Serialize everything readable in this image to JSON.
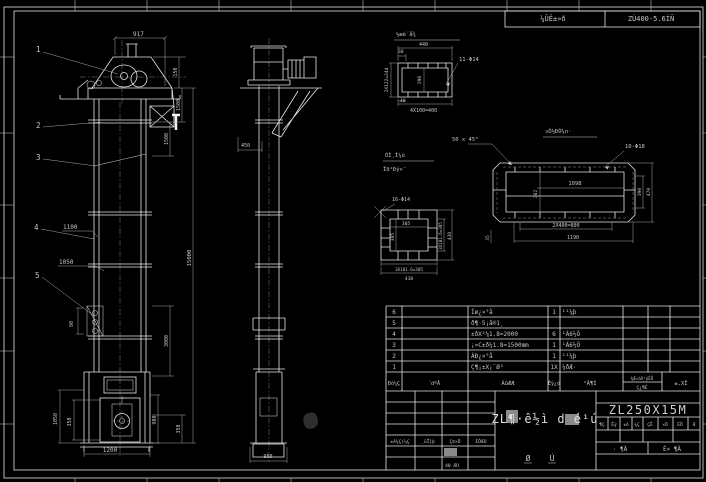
{
  "top_header": {
    "cell_left": "¼ÛÊ±»ð",
    "cell_right": "ZÙ400-5.6ÍÑ"
  },
  "front_view": {
    "balloons": [
      "1",
      "2",
      "3",
      "4",
      "5"
    ],
    "dim_top": "917",
    "dim_150": "150",
    "dim_1500a": "1500",
    "dim_1500b": "1500",
    "dim_3000": "3000",
    "dim_total": "15000",
    "callout_1100": "1100",
    "callout_1050": "1050",
    "dim_bucket": "90",
    "boot_left": "1050",
    "boot_left_inner": "350",
    "boot_right": "900",
    "dim_350": "350",
    "dim_base": "1200"
  },
  "side_view": {
    "dim_chute": "450",
    "dim_base": "950"
  },
  "detail_flange": {
    "title": "½æê´å¾",
    "dim_width": "440",
    "dim_30": "30",
    "dim_left": "2X122=244",
    "dim_inner": "296",
    "holes": "11-Φ14",
    "dim_40": "40",
    "dim_bottom": "4X100=400"
  },
  "chamfer_note": "50 x 45°",
  "weld_note": {
    "line1": "ÓÌ¸Ì¼ú",
    "line2": "Ïð²Ðý×¨"
  },
  "detail_square": {
    "holes": "16-Φ14",
    "dim_inner_w": "305",
    "dim_inner_h": "305",
    "dim_right": "3X101.6=305",
    "dim_right_total": "430",
    "dim_bottom": "3X101.6=305",
    "dim_bottom_total": "430"
  },
  "detail_long": {
    "title": "¤Ò½ÐÒ¼n·",
    "holes": "10-Φ18",
    "dim_inner": "1098",
    "dim_left": "362",
    "dim_right": "390",
    "dim_right_total": "470",
    "dim_bottom": "2X400=800",
    "dim_bottom_total": "1190",
    "dim_corner": "35"
  },
  "parts_table": {
    "header": {
      "col_no": "Ðò¼Ç",
      "col_code": "´dºÅ",
      "col_name": "ÃûÆÆ",
      "col_qty": "Êý¿ó",
      "col_material": "²Ä¶Ì",
      "col_note_top": "¼Æ»áX¹ýÈÕ",
      "col_note_bottom": "Ç¿¶È",
      "col_weight": "±,XÎ"
    },
    "rows": [
      {
        "no": "6",
        "name": "Íø¿×°å",
        "qty": "1",
        "material": "¹¹¼þ"
      },
      {
        "no": "5",
        "name": "ð¶·5¡ã®1¸",
        "qty": "",
        "material": ""
      },
      {
        "no": "4",
        "name": "±ðX²¼1.8=2000",
        "qty": "6",
        "material": "¹Ä6½Ö"
      },
      {
        "no": "3",
        "name": "¡¤C±ð¼1.8=1500mm",
        "qty": "1",
        "material": "¹Ä6½Ö"
      },
      {
        "no": "2",
        "name": "ÁÐ¿×°å",
        "qty": "1",
        "material": "¹¹¼þ"
      },
      {
        "no": "1",
        "name": "Ç¶¡±X¡¯Ø³",
        "qty": "1X",
        "material": "¼ðÆ·"
      }
    ]
  },
  "title_block": {
    "drawing_name": "ZL¶·ê½ì d é¹ú",
    "model": "ZL250X15M",
    "glyph_left": "Ø",
    "glyph_right": "Ú",
    "rev_row": [
      "±ê¼Ç(¼Ç",
      "¸üÎļþ",
      "Ç©×Ö",
      "ÈÕÆÚ"
    ],
    "date_cell": "40 ÆÚ",
    "sheet_left": "· ¶Ä",
    "sheet_right": "È× ¶Ä",
    "tiny_cells": [
      "¶Ç",
      "Êý",
      "±ê",
      "¼Ç",
      "ÇÊ",
      "×Ö",
      "ÈÕ",
      "Æ"
    ]
  }
}
